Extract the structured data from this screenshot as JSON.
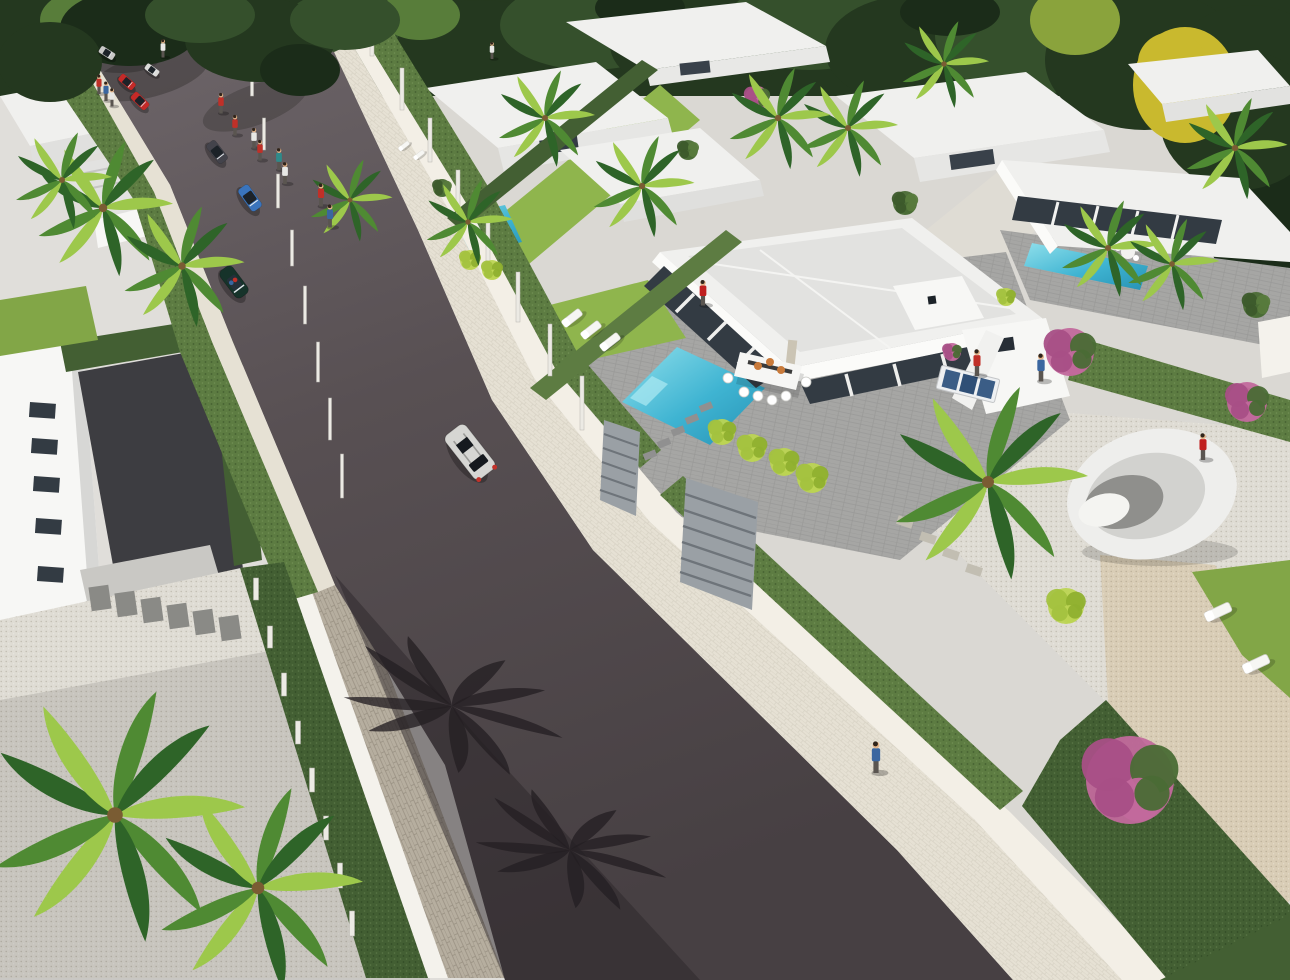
{
  "meta": {
    "type": "3d-architectural-render",
    "alt_text": "Aerial 3D render of a modern white-villa residential development: a dark asphalt street runs diagonally with cars and pedestrians, flat-roofed villas with turquoise pools, palm trees, hedges, pink flowering shrubs and gravel gardens on both sides, dense forest at the top."
  },
  "palette": {
    "forestDark": "#24381f",
    "forestMid": "#35502c",
    "forestDk2": "#1b2c19",
    "forestLight": "#587d3a",
    "treeYellow": "#c9b92e",
    "treeYellow2": "#8aa33c",
    "palmLight": "#9dc84b",
    "palmMid": "#4f8a33",
    "palmDark": "#2e6428",
    "palmShadow": "#241f22",
    "lawn": "#82a647",
    "lawnBright": "#8fb54d",
    "hedge": "#5d7c42",
    "hedgeDark": "#435f33",
    "road": "#585053",
    "roadLight": "#6e666a",
    "roadDark": "#474043",
    "roadShadow": "#2c2629",
    "walkCream": "#e6e1d4",
    "walkBright": "#f3efe6",
    "wallWhite": "#f4f2ec",
    "stone": "#b6ae9f",
    "gravel": "#d9cdb6",
    "gravelWhite": "#dfdcd4",
    "concrete": "#dad8d3",
    "concreteLight": "#e0deda",
    "roofWhite": "#f0f0ee",
    "roofShade": "#e2e2e0",
    "wallLight": "#f7f7f5",
    "wallShade": "#dcdcda",
    "glass": "#333b43",
    "terrace": "#a6a6a4",
    "pool": "#3fb4d2",
    "poolLight": "#8fdfeb",
    "poolDark": "#2792b4",
    "tableWhite": "#f6f6f4",
    "plate": "#c97a3a",
    "skin": "#e2b388",
    "gate": "#9aa0a5",
    "driveway": "#3d3d41",
    "pink": "#c2699c",
    "pinkDark": "#a84f86",
    "lime": "#bcd453",
    "carRed": "#c42a28",
    "carBlue": "#3a74bc",
    "carSilver": "#c9c9c7",
    "carWhite": "#dcdcda",
    "carDarkGray": "#43434b",
    "carGreen": "#16332a",
    "carSuv": "#d6d6d3",
    "shirtRed": "#c03028",
    "shirtBlue": "#3a66a0",
    "shirtWhite": "#e8e8e6",
    "shirtTeal": "#2f8a8a",
    "swimRed": "#c02020"
  },
  "scene": {
    "forest": [
      [
        40,
        45,
        85,
        55,
        "forestDark"
      ],
      [
        150,
        30,
        90,
        50,
        "forestMid"
      ],
      [
        260,
        55,
        80,
        55,
        "forestDark"
      ],
      [
        370,
        30,
        90,
        45,
        "forestMid"
      ],
      [
        480,
        50,
        85,
        50,
        "forestDark"
      ],
      [
        590,
        25,
        90,
        45,
        "forestMid"
      ],
      [
        700,
        45,
        90,
        50,
        "forestDark"
      ],
      [
        810,
        25,
        85,
        45,
        "forestMid"
      ],
      [
        915,
        50,
        90,
        55,
        "forestDark"
      ],
      [
        1030,
        35,
        95,
        60,
        "forestMid"
      ],
      [
        1145,
        60,
        100,
        70,
        "forestDark"
      ],
      [
        1250,
        90,
        90,
        85,
        "forestDark"
      ],
      [
        1272,
        210,
        70,
        85,
        "forestDk2"
      ],
      [
        1240,
        120,
        80,
        70,
        "forestDark"
      ],
      [
        1185,
        85,
        52,
        58,
        "treeYellow"
      ],
      [
        1172,
        62,
        34,
        30,
        "treeYellow"
      ],
      [
        1075,
        20,
        45,
        35,
        "treeYellow2"
      ],
      [
        85,
        20,
        45,
        30,
        "forestLight"
      ],
      [
        420,
        15,
        40,
        25,
        "forestLight"
      ],
      [
        640,
        8,
        45,
        22,
        "forestDk2"
      ],
      [
        950,
        12,
        50,
        24,
        "forestDk2"
      ]
    ],
    "forest_overhang": [
      [
        130,
        28,
        70,
        38,
        "forestDk2"
      ],
      [
        260,
        40,
        75,
        42,
        "forestDark"
      ],
      [
        345,
        20,
        55,
        30,
        "forestMid"
      ],
      [
        50,
        62,
        52,
        40,
        "forestDark"
      ],
      [
        300,
        70,
        40,
        26,
        "forestDk2"
      ],
      [
        200,
        15,
        55,
        28,
        "forestMid"
      ]
    ],
    "palms": [
      [
        115,
        815,
        2.6
      ],
      [
        258,
        888,
        2.1
      ],
      [
        988,
        482,
        2.0
      ],
      [
        103,
        208,
        1.4
      ],
      [
        182,
        266,
        1.25
      ],
      [
        545,
        118,
        1.0
      ],
      [
        642,
        186,
        1.05
      ],
      [
        848,
        128,
        1.0
      ],
      [
        944,
        64,
        0.9
      ],
      [
        778,
        118,
        1.05
      ],
      [
        1108,
        248,
        1.0
      ],
      [
        1172,
        264,
        0.95
      ],
      [
        1235,
        148,
        1.05
      ],
      [
        468,
        222,
        0.9
      ],
      [
        350,
        200,
        0.85
      ],
      [
        62,
        180,
        1.0
      ]
    ],
    "palm_shadows": [
      [
        452,
        706,
        2.3
      ],
      [
        570,
        850,
        2.0
      ]
    ],
    "cars": [
      [
        107,
        53,
        32,
        0.55,
        "carSilver",
        "sedan"
      ],
      [
        152,
        70,
        36,
        0.5,
        "carWhite",
        "sedan"
      ],
      [
        127,
        82,
        40,
        0.6,
        "carRed",
        "sedan"
      ],
      [
        140,
        101,
        44,
        0.65,
        "carRed",
        "sedan"
      ],
      [
        217,
        152,
        52,
        0.8,
        "carDarkGray",
        "sedan"
      ],
      [
        250,
        198,
        54,
        0.9,
        "carBlue",
        "sedan"
      ],
      [
        234,
        282,
        53,
        1.05,
        "carGreen",
        "cabrio"
      ],
      [
        470,
        452,
        52,
        1.55,
        "carSuv",
        "suv"
      ]
    ],
    "people": [
      [
        163,
        50,
        "shirtWhite",
        0.75
      ],
      [
        492,
        52,
        "shirtWhite",
        0.7
      ],
      [
        99,
        86,
        "shirtRed",
        0.8
      ],
      [
        106,
        93,
        "shirtBlue",
        0.8
      ],
      [
        112,
        99,
        "shirtWhite",
        0.75
      ],
      [
        221,
        105,
        "shirtRed",
        0.85
      ],
      [
        235,
        127,
        "shirtRed",
        0.85
      ],
      [
        254,
        140,
        "shirtWhite",
        0.85
      ],
      [
        260,
        152,
        "shirtRed",
        0.85
      ],
      [
        279,
        161,
        "shirtTeal",
        0.9
      ],
      [
        285,
        175,
        "shirtWhite",
        0.9
      ],
      [
        321,
        197,
        "shirtRed",
        0.95
      ],
      [
        330,
        218,
        "shirtBlue",
        0.95
      ],
      [
        703,
        295,
        "swimRed",
        1.05
      ],
      [
        977,
        365,
        "shirtRed",
        1.1
      ],
      [
        1041,
        370,
        "shirtBlue",
        1.15
      ],
      [
        1203,
        449,
        "swimRed",
        1.1
      ],
      [
        876,
        760,
        "shirtBlue",
        1.3
      ]
    ],
    "loungers": [
      [
        572,
        318,
        -38,
        1
      ],
      [
        591,
        330,
        -38,
        1
      ],
      [
        610,
        342,
        -38,
        1
      ],
      [
        404,
        146,
        -38,
        0.55
      ],
      [
        419,
        155,
        -38,
        0.55
      ],
      [
        1218,
        612,
        -25,
        1.25
      ],
      [
        1256,
        664,
        -25,
        1.25
      ]
    ],
    "posts": [
      [
        372,
        56,
        40,
        4
      ],
      [
        402,
        110,
        42,
        4
      ],
      [
        430,
        162,
        44,
        4
      ],
      [
        458,
        216,
        46,
        4
      ],
      [
        488,
        268,
        48,
        4
      ],
      [
        518,
        322,
        50,
        4
      ],
      [
        550,
        376,
        52,
        4
      ],
      [
        582,
        430,
        54,
        4
      ],
      [
        252,
        96,
        30,
        3
      ],
      [
        264,
        150,
        32,
        3
      ],
      [
        278,
        208,
        34,
        3
      ],
      [
        292,
        266,
        36,
        3
      ],
      [
        305,
        324,
        38,
        3
      ],
      [
        318,
        382,
        40,
        3
      ],
      [
        330,
        440,
        42,
        3
      ],
      [
        342,
        498,
        44,
        3
      ],
      [
        256,
        600,
        22,
        5
      ],
      [
        270,
        648,
        22,
        5
      ],
      [
        284,
        696,
        23,
        5
      ],
      [
        298,
        744,
        23,
        5
      ],
      [
        312,
        792,
        24,
        5
      ],
      [
        326,
        840,
        24,
        5
      ],
      [
        340,
        888,
        25,
        5
      ],
      [
        352,
        936,
        25,
        5
      ]
    ],
    "stones": [
      [
        650,
        455,
        13,
        7,
        -22,
        "#909090"
      ],
      [
        664,
        443,
        13,
        7,
        -22,
        "#909090"
      ],
      [
        678,
        431,
        13,
        7,
        -22,
        "#909090"
      ],
      [
        692,
        419,
        13,
        7,
        -22,
        "#909090"
      ],
      [
        706,
        407,
        13,
        7,
        -22,
        "#909090"
      ],
      [
        100,
        598,
        20,
        24,
        -8,
        "#8a8a86"
      ],
      [
        126,
        604,
        20,
        24,
        -8,
        "#8a8a86"
      ],
      [
        152,
        610,
        20,
        24,
        -8,
        "#8a8a86"
      ],
      [
        178,
        616,
        20,
        24,
        -8,
        "#8a8a86"
      ],
      [
        204,
        622,
        20,
        24,
        -8,
        "#8a8a86"
      ],
      [
        230,
        628,
        20,
        24,
        -8,
        "#8a8a86"
      ],
      [
        905,
        522,
        16,
        9,
        18,
        "#c2beb2"
      ],
      [
        928,
        538,
        16,
        9,
        18,
        "#c2beb2"
      ],
      [
        951,
        554,
        16,
        9,
        18,
        "#c2beb2"
      ],
      [
        974,
        570,
        16,
        9,
        18,
        "#c2beb2"
      ]
    ],
    "bushes": [
      [
        757,
        98,
        12,
        "pink"
      ],
      [
        1070,
        352,
        24,
        "pink"
      ],
      [
        1247,
        402,
        20,
        "pink"
      ],
      [
        1130,
        780,
        44,
        "pink"
      ],
      [
        952,
        352,
        9,
        "pink"
      ],
      [
        722,
        432,
        13,
        "lime"
      ],
      [
        752,
        448,
        14,
        "lime"
      ],
      [
        784,
        462,
        14,
        "lime"
      ],
      [
        812,
        478,
        15,
        "lime"
      ],
      [
        470,
        260,
        10,
        "lime"
      ],
      [
        492,
        270,
        10,
        "lime"
      ],
      [
        1066,
        606,
        18,
        "lime"
      ],
      [
        1006,
        297,
        9,
        "lime"
      ],
      [
        905,
        203,
        12,
        "green"
      ],
      [
        1256,
        305,
        13,
        "green"
      ],
      [
        442,
        188,
        9,
        "green"
      ],
      [
        688,
        150,
        10,
        "green"
      ]
    ],
    "windows": [
      [
        30,
        402
      ],
      [
        32,
        438
      ],
      [
        34,
        476
      ],
      [
        36,
        518
      ],
      [
        38,
        566
      ]
    ]
  }
}
